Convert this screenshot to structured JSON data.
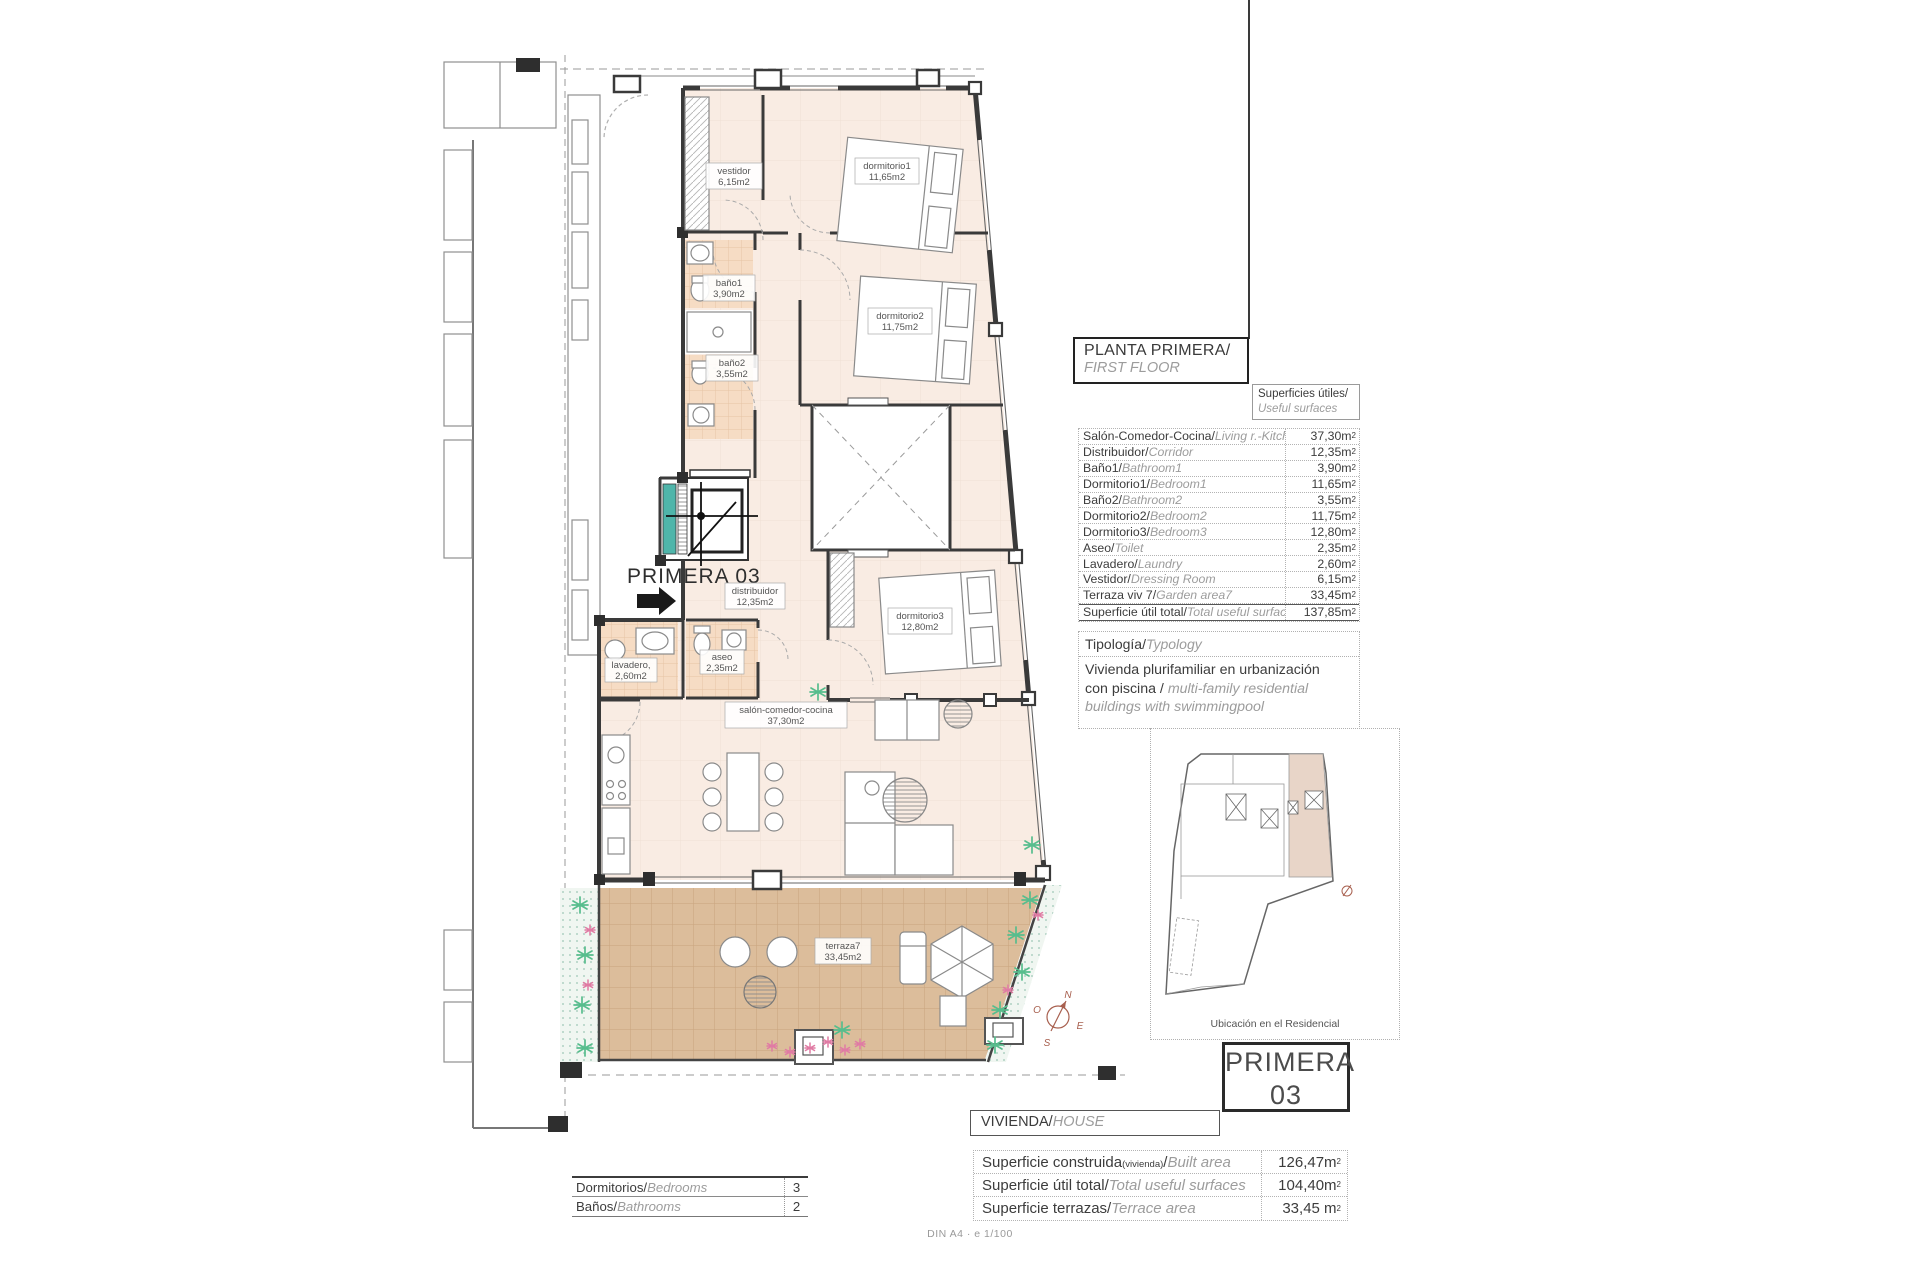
{
  "plan": {
    "unit_arrow_label": "PRIMERA 03",
    "room_labels": [
      {
        "name": "vestidor",
        "area": "6,15m2"
      },
      {
        "name": "dormitorio1",
        "area": "11,65m2"
      },
      {
        "name": "baño1",
        "area": "3,90m2"
      },
      {
        "name": "baño2",
        "area": "3,55m2"
      },
      {
        "name": "dormitorio2",
        "area": "11,75m2"
      },
      {
        "name": "distribuidor",
        "area": "12,35m2"
      },
      {
        "name": "aseo",
        "area": "2,35m2"
      },
      {
        "name": "lavadero,",
        "area": "2,60m2"
      },
      {
        "name": "dormitorio3",
        "area": "12,80m2"
      },
      {
        "name": "salón-comedor-cocina",
        "area": "37,30m2"
      },
      {
        "name": "terraza7",
        "area": "33,45m2"
      }
    ],
    "compass": {
      "n": "N",
      "o": "O",
      "e": "E",
      "s": "S"
    }
  },
  "title_block": {
    "es": "PLANTA PRIMERA/",
    "en": "FIRST FLOOR"
  },
  "surfaces": {
    "label_es": "Superficies útiles/",
    "label_en": "Useful surfaces",
    "sup": "2",
    "rows": [
      {
        "es": "Salón-Comedor-Cocina/",
        "en": "Living r.-Kitchen",
        "value": "37,30m"
      },
      {
        "es": "Distribuidor/",
        "en": "Corridor",
        "value": "12,35m"
      },
      {
        "es": "Baño1/",
        "en": "Bathroom1",
        "value": "3,90m"
      },
      {
        "es": "Dormitorio1/",
        "en": "Bedroom1",
        "value": "11,65m"
      },
      {
        "es": "Baño2/",
        "en": "Bathroom2",
        "value": "3,55m"
      },
      {
        "es": "Dormitorio2/",
        "en": "Bedroom2",
        "value": "11,75m"
      },
      {
        "es": "Dormitorio3/",
        "en": "Bedroom3",
        "value": "12,80m"
      },
      {
        "es": "Aseo/",
        "en": "Toilet",
        "value": "2,35m"
      },
      {
        "es": "Lavadero/",
        "en": "Laundry",
        "value": "2,60m"
      },
      {
        "es": "Vestidor/",
        "en": "Dressing Room",
        "value": "6,15m"
      },
      {
        "es": "Terraza viv 7/",
        "en": "Garden area7",
        "value": "33,45m"
      },
      {
        "es": "Superficie útil total/",
        "en": "Total useful surface",
        "value": "137,85m"
      }
    ]
  },
  "typology": {
    "label_es": "Tipología/",
    "label_en": "Typology",
    "body_es": "Vivienda plurifamiliar en urbanización con piscina ",
    "body_sep": "/ ",
    "body_en": "multi-family residential buildings with swimmingpool"
  },
  "location": {
    "caption": "Ubicación en el Residencial"
  },
  "unit_badge": {
    "line1": "PRIMERA",
    "line2": "03"
  },
  "house_block": {
    "header_es": "VIVIENDA/",
    "header_en": "HOUSE",
    "sup": "2",
    "rows": [
      {
        "es": "Superficie construida",
        "es_small": "(vivienda)",
        "es_slash": "/",
        "en": "Built area",
        "value": "126,47m"
      },
      {
        "es": "Superficie útil total/",
        "en": "Total useful surfaces",
        "value": "104,40m"
      },
      {
        "es": "Superficie terrazas/",
        "en": "Terrace area",
        "value": "33,45 m"
      }
    ]
  },
  "program": {
    "rows": [
      {
        "es": "Dormitorios/",
        "en": "Bedrooms",
        "value": "3"
      },
      {
        "es": "Baños/",
        "en": "Bathrooms",
        "value": "2"
      }
    ]
  },
  "sheet": {
    "scale_note": "DIN A4 · e 1/100"
  }
}
